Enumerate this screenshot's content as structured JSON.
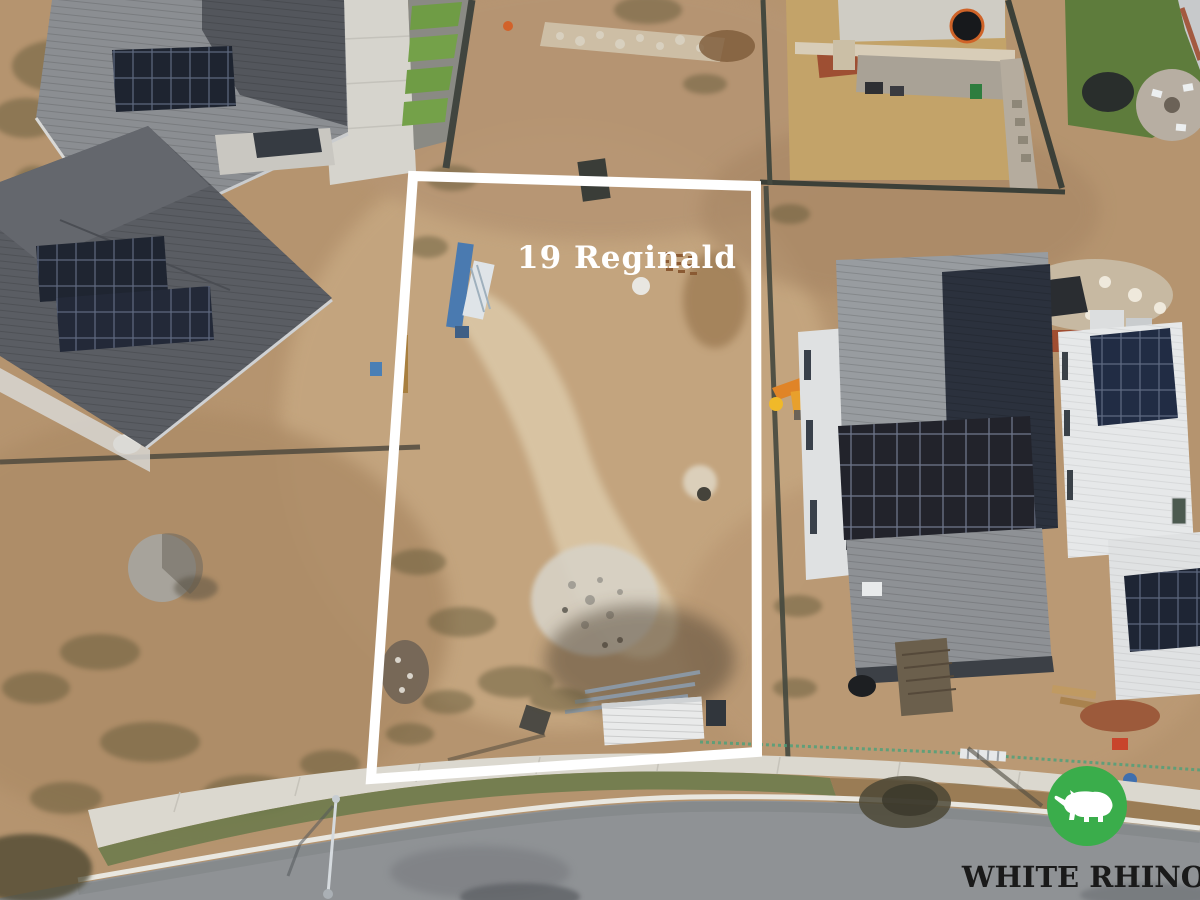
{
  "property": {
    "label": "19 Reginald",
    "label_color": "#ffffff"
  },
  "boundary": {
    "color": "#ffffff"
  },
  "logo": {
    "brand": "WHITE RHINO",
    "icon": "rhino-icon",
    "circle_color": "#3aad4b",
    "rhino_color": "#ffffff",
    "text_color": "#1a1a1a"
  }
}
